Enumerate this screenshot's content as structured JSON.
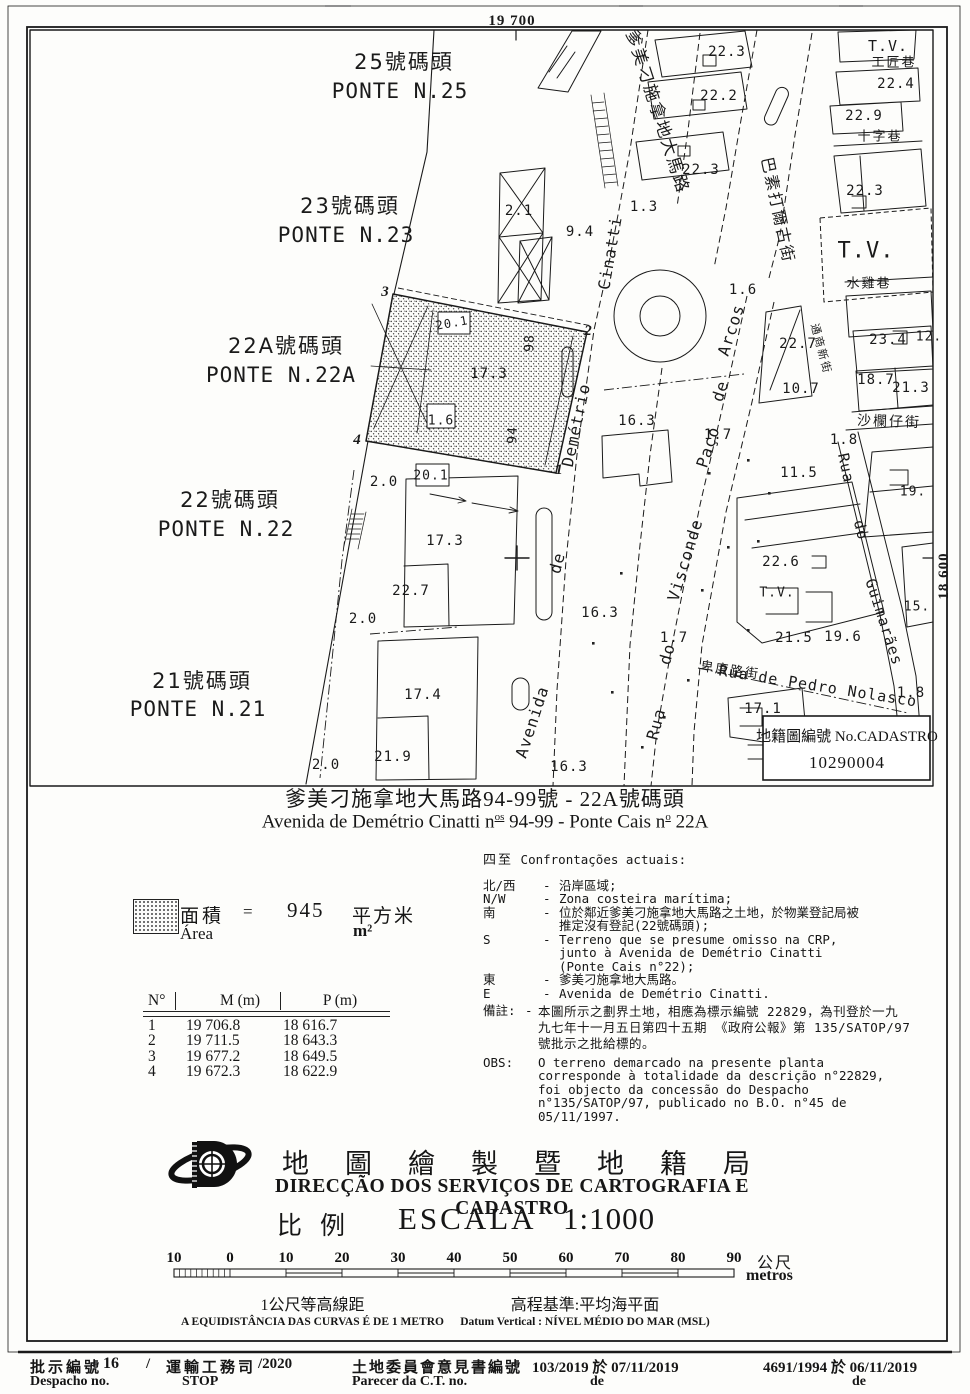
{
  "map": {
    "cadastro": {
      "label": "地籍圖編號 No.CADASTRO",
      "number": "10290004"
    },
    "labels": [
      {
        "n": "grid-coordinate-top",
        "t": "19 700",
        "x": 512,
        "y": 21,
        "c": "grid",
        "s": 15
      },
      {
        "n": "grid-coordinate-right",
        "t": "18 600",
        "x": 944,
        "y": 576,
        "r": -90,
        "c": "grid",
        "s": 15
      },
      {
        "n": "pier-label",
        "t": "25號碼頭",
        "x": 404,
        "y": 62,
        "c": "cadzh",
        "s": 21
      },
      {
        "n": "pier-label",
        "t": "PONTE N.25",
        "x": 400,
        "y": 91,
        "c": "cad",
        "s": 21
      },
      {
        "n": "pier-label",
        "t": "23號碼頭",
        "x": 350,
        "y": 206,
        "c": "cadzh",
        "s": 21
      },
      {
        "n": "pier-label",
        "t": "PONTE N.23",
        "x": 346,
        "y": 235,
        "c": "cad",
        "s": 21
      },
      {
        "n": "pier-label",
        "t": "22A號碼頭",
        "x": 286,
        "y": 346,
        "c": "cadzh",
        "s": 21
      },
      {
        "n": "pier-label",
        "t": "PONTE N.22A",
        "x": 281,
        "y": 375,
        "c": "cad",
        "s": 21
      },
      {
        "n": "pier-label",
        "t": "22號碼頭",
        "x": 230,
        "y": 500,
        "c": "cadzh",
        "s": 21
      },
      {
        "n": "pier-label",
        "t": "PONTE N.22",
        "x": 226,
        "y": 529,
        "c": "cad",
        "s": 21
      },
      {
        "n": "pier-label",
        "t": "21號碼頭",
        "x": 202,
        "y": 681,
        "c": "cadzh",
        "s": 21
      },
      {
        "n": "pier-label",
        "t": "PONTE N.21",
        "x": 198,
        "y": 709,
        "c": "cad",
        "s": 21
      },
      {
        "n": "street-label",
        "t": "爹美刁施拿地大馬路",
        "x": 657,
        "y": 112,
        "r": 72,
        "c": "cadzh",
        "s": 17
      },
      {
        "n": "street-label",
        "t": "Cinatti",
        "x": 610,
        "y": 253,
        "r": -80,
        "c": "cad",
        "s": 16
      },
      {
        "n": "street-label",
        "t": "Demétrio",
        "x": 576,
        "y": 425,
        "r": -78,
        "c": "cad",
        "s": 16
      },
      {
        "n": "street-label",
        "t": "de",
        "x": 557,
        "y": 563,
        "r": -75,
        "c": "cad",
        "s": 16
      },
      {
        "n": "street-label",
        "t": "Avenida",
        "x": 532,
        "y": 722,
        "r": -72,
        "c": "cad",
        "s": 16
      },
      {
        "n": "street-label",
        "t": "巴素打爾古街",
        "x": 778,
        "y": 210,
        "r": 78,
        "c": "cadzh",
        "s": 16
      },
      {
        "n": "street-label",
        "t": "Arcos",
        "x": 731,
        "y": 330,
        "r": -72,
        "c": "cad",
        "s": 16
      },
      {
        "n": "street-label",
        "t": "de",
        "x": 720,
        "y": 391,
        "r": -72,
        "c": "cad",
        "s": 16
      },
      {
        "n": "street-label",
        "t": "Paço",
        "x": 708,
        "y": 447,
        "r": -72,
        "c": "cad",
        "s": 16
      },
      {
        "n": "street-label",
        "t": "Visconde",
        "x": 685,
        "y": 560,
        "r": -73,
        "c": "cad",
        "s": 16
      },
      {
        "n": "street-label",
        "t": "do",
        "x": 667,
        "y": 654,
        "r": -74,
        "c": "cad",
        "s": 16
      },
      {
        "n": "street-label",
        "t": "Rua",
        "x": 656,
        "y": 724,
        "r": -75,
        "c": "cad",
        "s": 16
      },
      {
        "n": "street-label",
        "t": "Rua",
        "x": 846,
        "y": 468,
        "r": 78,
        "c": "cad",
        "s": 15
      },
      {
        "n": "street-label",
        "t": "do",
        "x": 861,
        "y": 530,
        "r": 76,
        "c": "cad",
        "s": 15
      },
      {
        "n": "street-label",
        "t": "Guimarães",
        "x": 884,
        "y": 622,
        "r": 72,
        "c": "cad",
        "s": 15
      },
      {
        "n": "street-label",
        "t": "Rua de Pedro Nolasco",
        "x": 818,
        "y": 686,
        "r": 9,
        "c": "cad",
        "s": 15
      },
      {
        "n": "street-label",
        "t": "卑度路街",
        "x": 730,
        "y": 671,
        "r": 8,
        "c": "cadzh",
        "s": 13
      },
      {
        "n": "street-label",
        "t": "沙欄仔街",
        "x": 889,
        "y": 422,
        "r": 2,
        "c": "cadzh",
        "s": 14
      },
      {
        "n": "street-label",
        "t": "水雞巷",
        "x": 869,
        "y": 284,
        "c": "cadzh",
        "s": 13
      },
      {
        "n": "street-label",
        "t": "工匠巷",
        "x": 894,
        "y": 63,
        "c": "cadzh",
        "s": 13
      },
      {
        "n": "street-label",
        "t": "十字巷",
        "x": 880,
        "y": 137,
        "c": "cadzh",
        "s": 13
      },
      {
        "n": "street-label",
        "t": "通商新街",
        "x": 821,
        "y": 349,
        "r": 75,
        "c": "cadzh",
        "s": 11
      },
      {
        "n": "tv-label",
        "t": "T.V.",
        "x": 888,
        "y": 46,
        "c": "cad",
        "s": 15
      },
      {
        "n": "tv-label",
        "t": "T.V.",
        "x": 866,
        "y": 251,
        "c": "cad",
        "s": 22,
        "ls": 6
      },
      {
        "n": "tv-label",
        "t": "T.V.",
        "x": 777,
        "y": 593,
        "c": "cad",
        "s": 13
      },
      {
        "n": "elevation-label",
        "t": "22.3",
        "x": 727,
        "y": 52
      },
      {
        "n": "elevation-label",
        "t": "22.2",
        "x": 719,
        "y": 96
      },
      {
        "n": "elevation-label",
        "t": "22.3",
        "x": 701,
        "y": 170
      },
      {
        "n": "elevation-label",
        "t": "22.4",
        "x": 896,
        "y": 84
      },
      {
        "n": "elevation-label",
        "t": "22.9",
        "x": 864,
        "y": 116
      },
      {
        "n": "elevation-label",
        "t": "22.3",
        "x": 865,
        "y": 191
      },
      {
        "n": "elevation-label",
        "t": "1.3",
        "x": 644,
        "y": 207
      },
      {
        "n": "elevation-label",
        "t": "2.1",
        "x": 519,
        "y": 211
      },
      {
        "n": "elevation-label",
        "t": "9.4",
        "x": 580,
        "y": 232
      },
      {
        "n": "elevation-label",
        "t": "1.6",
        "x": 743,
        "y": 290
      },
      {
        "n": "elevation-label",
        "t": "23.4",
        "x": 888,
        "y": 340
      },
      {
        "n": "elevation-label",
        "t": "12.",
        "x": 929,
        "y": 337,
        "s": 13
      },
      {
        "n": "elevation-label",
        "t": "22.7",
        "x": 798,
        "y": 344
      },
      {
        "n": "elevation-label",
        "t": "10.7",
        "x": 801,
        "y": 389
      },
      {
        "n": "elevation-label",
        "t": "18.7",
        "x": 876,
        "y": 380
      },
      {
        "n": "elevation-label",
        "t": "21.3",
        "x": 911,
        "y": 388
      },
      {
        "n": "elevation-label",
        "t": "16.3",
        "x": 637,
        "y": 421
      },
      {
        "n": "elevation-label",
        "t": "1.7",
        "x": 718,
        "y": 435
      },
      {
        "n": "elevation-label",
        "t": "1.8",
        "x": 844,
        "y": 440
      },
      {
        "n": "elevation-label",
        "t": "11.5",
        "x": 799,
        "y": 473
      },
      {
        "n": "elevation-label",
        "t": "19.",
        "x": 913,
        "y": 492,
        "s": 13
      },
      {
        "n": "elevation-label",
        "t": "22.6",
        "x": 781,
        "y": 562
      },
      {
        "n": "elevation-label",
        "t": "15.",
        "x": 917,
        "y": 607,
        "s": 13
      },
      {
        "n": "elevation-label",
        "t": "21.5",
        "x": 794,
        "y": 638
      },
      {
        "n": "elevation-label",
        "t": "19.6",
        "x": 843,
        "y": 637
      },
      {
        "n": "elevation-label",
        "t": "1.7",
        "x": 674,
        "y": 638
      },
      {
        "n": "elevation-label",
        "t": "17.1",
        "x": 763,
        "y": 709
      },
      {
        "n": "elevation-label",
        "t": "1.8",
        "x": 911,
        "y": 693
      },
      {
        "n": "elevation-label",
        "t": "16.3",
        "x": 600,
        "y": 613
      },
      {
        "n": "elevation-label",
        "t": "16.3",
        "x": 569,
        "y": 767
      },
      {
        "n": "elevation-label",
        "t": "17.3",
        "x": 489,
        "y": 374
      },
      {
        "n": "elevation-label",
        "t": "1.6",
        "x": 441,
        "y": 421,
        "s": 13
      },
      {
        "n": "door-number",
        "t": "98",
        "x": 530,
        "y": 343,
        "r": -88,
        "s": 13
      },
      {
        "n": "door-number",
        "t": "94",
        "x": 513,
        "y": 435,
        "r": -88,
        "s": 13
      },
      {
        "n": "elevation-label",
        "t": "20.1",
        "x": 452,
        "y": 323,
        "r": -10,
        "s": 12
      },
      {
        "n": "elevation-label",
        "t": "20.1",
        "x": 431,
        "y": 476,
        "s": 13
      },
      {
        "n": "elevation-label",
        "t": "17.3",
        "x": 445,
        "y": 541
      },
      {
        "n": "elevation-label",
        "t": "22.7",
        "x": 411,
        "y": 591
      },
      {
        "n": "elevation-label",
        "t": "17.4",
        "x": 423,
        "y": 695
      },
      {
        "n": "elevation-label",
        "t": "21.9",
        "x": 393,
        "y": 757
      },
      {
        "n": "elevation-label",
        "t": "2.0",
        "x": 384,
        "y": 482
      },
      {
        "n": "elevation-label",
        "t": "2.0",
        "x": 363,
        "y": 619
      },
      {
        "n": "elevation-label",
        "t": "2.0",
        "x": 326,
        "y": 765
      },
      {
        "n": "boundary-point-number",
        "t": "3",
        "x": 385,
        "y": 292,
        "c": "corner",
        "s": 15
      },
      {
        "n": "boundary-point-number",
        "t": "2",
        "x": 588,
        "y": 331,
        "c": "corner",
        "s": 15
      },
      {
        "n": "boundary-point-number",
        "t": "1",
        "x": 559,
        "y": 470,
        "c": "corner",
        "s": 15
      },
      {
        "n": "boundary-point-number",
        "t": "4",
        "x": 357,
        "y": 440,
        "c": "corner",
        "s": 15
      }
    ]
  },
  "title": {
    "zh": "爹美刁施拿地大馬路94-99號 - 22A號碼頭",
    "pt_a": "Avenida de Demétrio Cinatti n",
    "pt_sup1": "os",
    "pt_b": " 94-99 - Ponte Cais n",
    "pt_sup2": "o",
    "pt_c": " 22A"
  },
  "legend": {
    "zh_label": "面積",
    "equals": "=",
    "value": "945",
    "zh_unit": "平方米",
    "pt_label": "Área",
    "pt_unit": "m²"
  },
  "coords_table": {
    "headers": [
      "N°",
      "M (m)",
      "P (m)"
    ],
    "rows": [
      [
        "1",
        "19 706.8",
        "18 616.7"
      ],
      [
        "2",
        "19 711.5",
        "18 643.3"
      ],
      [
        "3",
        "19 677.2",
        "18 649.5"
      ],
      [
        "4",
        "19 672.3",
        "18 622.9"
      ]
    ]
  },
  "confrontations": {
    "zh": "四至",
    "pt": "Confrontações actuais:",
    "items": [
      {
        "label": "北/西",
        "dash": "-",
        "text": "沿岸區域;"
      },
      {
        "label": "N/W",
        "dash": "-",
        "text": "Zona costeira marítima;"
      },
      {
        "label": "南",
        "dash": "-",
        "text": "位於鄰近爹美刁施拿地大馬路之土地，於物業登記局被\n推定沒有登記(22號碼頭);"
      },
      {
        "label": "S",
        "dash": "-",
        "text": "Terreno que se presume omisso na CRP,\njunto à Avenida de Demétrio Cinatti\n(Ponte Cais n°22);"
      },
      {
        "label": "東",
        "dash": "-",
        "text": "爹美刁施拿地大馬路。"
      },
      {
        "label": "E",
        "dash": "-",
        "text": "Avenida de Demétrio Cinatti."
      }
    ]
  },
  "notes": {
    "zh_label": "備註:",
    "zh_dash": "-",
    "zh_text": "本圖所示之劃界土地，相應為標示編號 22829，為刊登於一九\n九七年十一月五日第四十五期 《政府公報》第 135/SATOP/97\n號批示之批給標的。",
    "obs_label": "OBS:",
    "obs_text": "O terreno demarcado na presente planta\ncorresponde à totalidade da descrição n°22829,\nfoi objecto da concessão do Despacho\nn°135/SATOP/97, publicado no B.O. n°45 de\n05/11/1997."
  },
  "agency": {
    "zh": "地圖繪製暨地籍局",
    "pt": "DIRECÇÃO DOS SERVIÇOS DE CARTOGRAFIA E CADASTRO",
    "scale_zh": "比例",
    "scale_word": "ESCALA",
    "scale_value": "1:1000"
  },
  "scalebar": {
    "ticks": [
      "10",
      "0",
      "10",
      "20",
      "30",
      "40",
      "50",
      "60",
      "70",
      "80",
      "90"
    ],
    "unit_zh": "公尺",
    "unit_pt": "metros",
    "contour_zh": "1公尺等高線距",
    "contour_pt": "A EQUIDISTÂNCIA DAS CURVAS É DE 1 METRO",
    "datum_zh": "高程基準:平均海平面",
    "datum_pt": "Datum Vertical : NÍVEL MÉDIO DO MAR (MSL)"
  },
  "footer": {
    "despacho_zh": "批示編號",
    "despacho_no": "16",
    "slash": "/",
    "dept_zh": "運輸工務司",
    "year_suffix": "/2020",
    "despacho_pt": "Despacho no.",
    "dept_abbr": "STOP",
    "parecer_zh": "土地委員會意見書編號",
    "parecer_value": "103/2019 於 07/11/2019",
    "parecer_pt": "Parecer da C.T. no.",
    "parecer_de": "de",
    "concessao_value": "4691/1994 於 06/11/2019",
    "concessao_de": "de"
  }
}
